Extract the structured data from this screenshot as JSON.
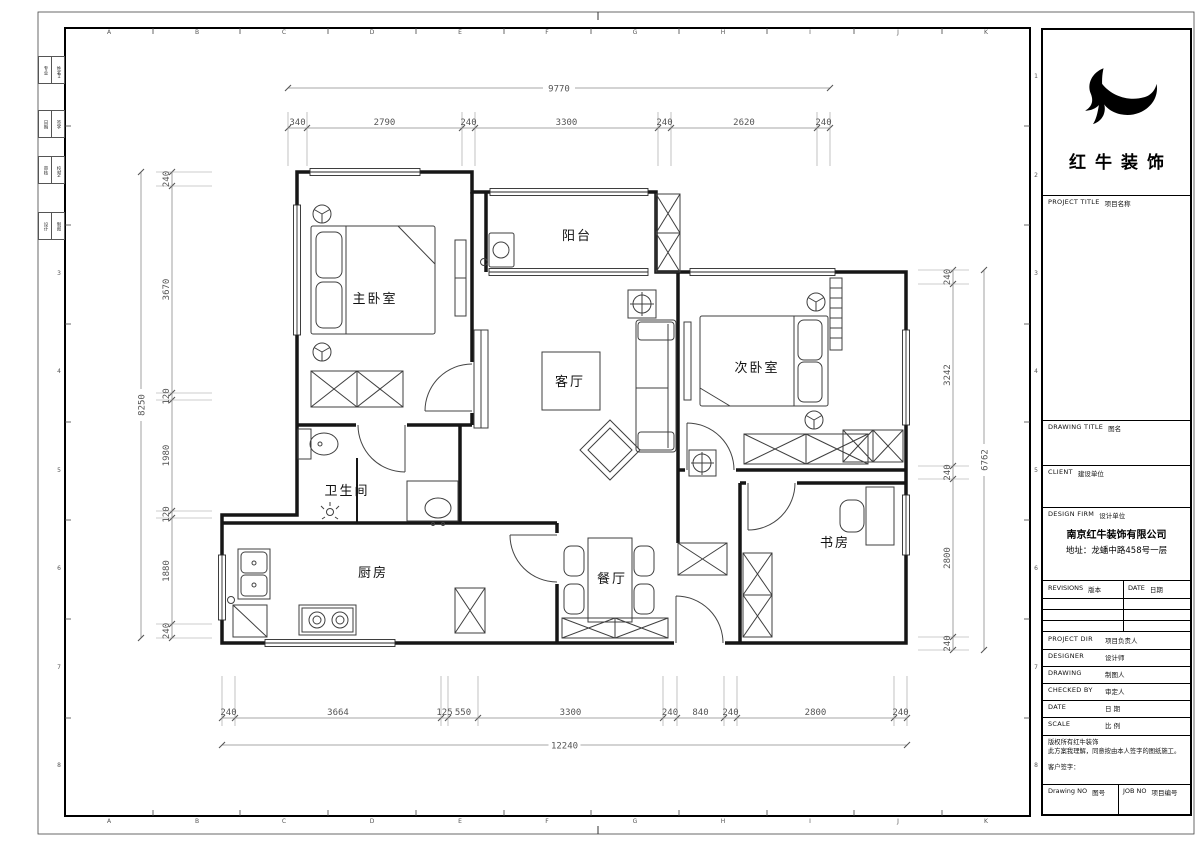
{
  "sheet": {
    "grid_letters": [
      "A",
      "B",
      "C",
      "D",
      "E",
      "F",
      "G",
      "H",
      "I",
      "J",
      "K"
    ],
    "grid_numbers": [
      "1",
      "2",
      "3",
      "4",
      "5",
      "6",
      "7",
      "8"
    ],
    "signoff_strip": {
      "rows": [
        [
          "专业",
          "姓名"
        ],
        [
          "日期",
          "签字"
        ],
        [
          "审核",
          "校对"
        ],
        [
          "设计",
          "制图"
        ]
      ]
    }
  },
  "plan": {
    "rooms": [
      {
        "id": "master-bedroom",
        "label": "主卧室"
      },
      {
        "id": "balcony",
        "label": "阳台"
      },
      {
        "id": "second-bedroom",
        "label": "次卧室"
      },
      {
        "id": "living-room",
        "label": "客厅"
      },
      {
        "id": "bathroom",
        "label": "卫生间"
      },
      {
        "id": "kitchen",
        "label": "厨房"
      },
      {
        "id": "dining-room",
        "label": "餐厅"
      },
      {
        "id": "study",
        "label": "书房"
      }
    ],
    "dims": {
      "top_total": "9770",
      "top": [
        "340",
        "2790",
        "240",
        "3300",
        "240",
        "2620",
        "240"
      ],
      "left_total": "8250",
      "left": [
        "240",
        "3670",
        "120",
        "1980",
        "120",
        "1880",
        "240"
      ],
      "right_total": "6762",
      "right": [
        "240",
        "3242",
        "240",
        "2800",
        "240"
      ],
      "bottom": [
        "240",
        "3664",
        "125",
        "550",
        "3300",
        "240",
        "840",
        "240",
        "2800",
        "240"
      ],
      "bottom_total": "12240"
    }
  },
  "titleblock": {
    "brand": "红牛装饰",
    "project_title": {
      "en": "PROJECT TITLE",
      "cn": "项目名称"
    },
    "drawing_title": {
      "en": "DRAWING TITLE",
      "cn": "图名"
    },
    "client": {
      "en": "CLIENT",
      "cn": "建设单位"
    },
    "design_firm": {
      "en": "DESIGN FIRM",
      "cn": "设计单位"
    },
    "company": "南京红牛装饰有限公司",
    "address": "地址：龙蟠中路458号一层",
    "revisions": {
      "en": "REVISIONS",
      "cn": "版本"
    },
    "date_col": {
      "en": "DATE",
      "cn": "日期"
    },
    "rows": [
      {
        "en": "PROJECT DIR",
        "cn": "项目负责人"
      },
      {
        "en": "DESIGNER",
        "cn": "设计师"
      },
      {
        "en": "DRAWING",
        "cn": "制图人"
      },
      {
        "en": "CHECKED BY",
        "cn": "审定人"
      },
      {
        "en": "DATE",
        "cn": "日  期"
      },
      {
        "en": "SCALE",
        "cn": "比  例"
      }
    ],
    "copyright1": "版权所有红牛装饰",
    "copyright2": "此方案我理解，同意按由本人签字的图纸施工。",
    "client_sign": "客户签字：",
    "drawing_no": {
      "en": "Drawing NO",
      "cn": "图号"
    },
    "job_no": {
      "en": "JOB NO",
      "cn": "项目编号"
    }
  }
}
